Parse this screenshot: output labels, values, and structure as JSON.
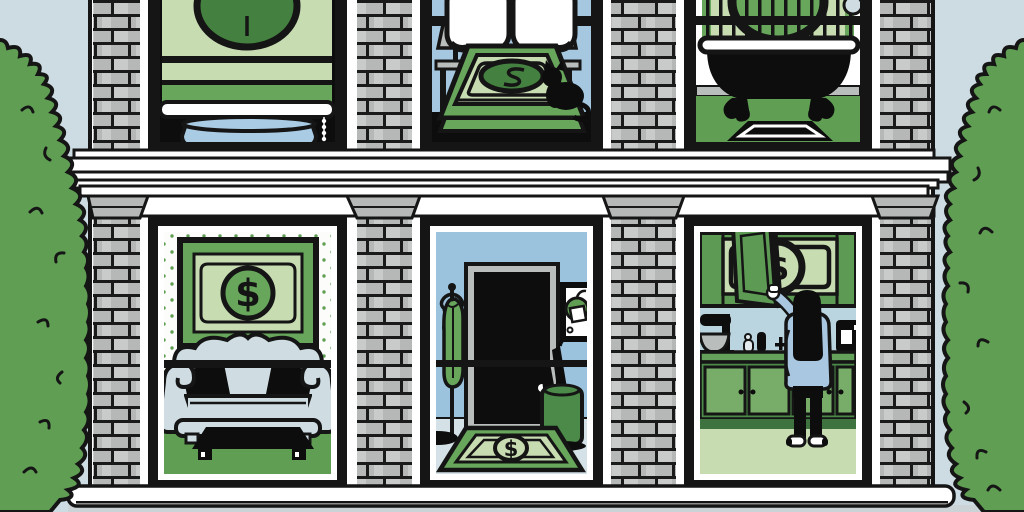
{
  "scene": {
    "type": "editorial-illustration",
    "subject": "cutaway brick townhouse where dollar bills appear as household objects",
    "setting_items": [
      "sky",
      "cloud",
      "left-bush",
      "right-bush",
      "brick-facade",
      "cornice",
      "window-lintels",
      "bottom-ledge"
    ],
    "rooms": {
      "top_left_window": [
        "dollar-roller-blind",
        "blind-seal",
        "blind-pull-chain",
        "window-planter",
        "planter-shrub"
      ],
      "bedroom": [
        "headboard-bar",
        "pillows",
        "bedside-lamp-left",
        "bedside-lamp-right",
        "dollar-bedspread",
        "bedspread-seal",
        "black-cat"
      ],
      "bathroom": [
        "dollar-shower-curtain",
        "curtain-seal",
        "curtain-rod",
        "shower-hook",
        "clawfoot-bathtub",
        "bath-mat"
      ],
      "living_room": [
        "polka-dot-wallpaper",
        "framed-dollar-art",
        "camelback-sofa",
        "black-throw-pillows",
        "coffee-table",
        "window-mullion"
      ],
      "hallway": [
        "coat-rack",
        "green-coat",
        "front-door",
        "door-knob",
        "wall-picture",
        "umbrella-stand",
        "umbrellas",
        "dollar-doormat",
        "window-mullion"
      ],
      "kitchen": [
        "upper-cabinets",
        "open-cabinet-door",
        "dollar-bill-in-cabinet",
        "cabinet-seal",
        "woman-reaching",
        "stand-mixer",
        "counter-items",
        "coffee-maker",
        "countertop",
        "base-cabinets"
      ]
    }
  },
  "glyphs": {
    "dollar_sign": "$"
  },
  "colors": {
    "outline": "#151515",
    "sky": "#cddbe2",
    "cloud": "#ffffff",
    "bush": "#5f9e53",
    "brick": "#b5b8b6",
    "brick_light": "#c8cbc9",
    "mortar": "#1a1a1a",
    "trim_white": "#ffffff",
    "dollar_light": "#c8dcb2",
    "dollar_mid": "#68a65c",
    "dollar_dark": "#44803f",
    "wall_bedroom": "#a5c8e0",
    "wall_hall": "#9cc3dd",
    "wall_kitchen": "#bad5e0",
    "wall_bath": "#ffffff",
    "wallpaper": "#fcfdfa",
    "floor_green": "#5f9e53",
    "floor_kitchen": "#c8dcb2",
    "floor_hall": "#d4e2e8",
    "sofa": "#cfdde3",
    "lamp_gray": "#b9bdbb",
    "baseboard_gray": "#b9bdbb",
    "planter": "#a9cbe4",
    "shirt": "#a9c7e1",
    "cab_upper": "#5d9b54",
    "cab_base": "#4b8a49",
    "cab_panel": "#77ad68",
    "counter": "#64a25b",
    "stand_green": "#4b8a49",
    "ledge_gray": "#ccd3d7",
    "black": "#141414"
  }
}
